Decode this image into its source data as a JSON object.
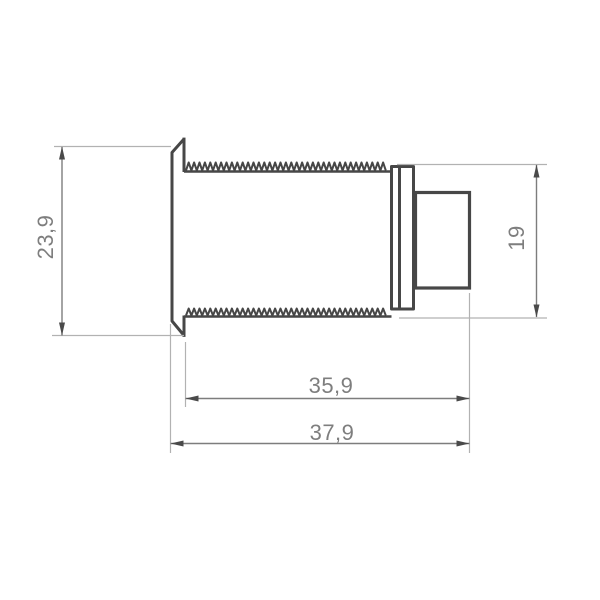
{
  "drawing": {
    "kind": "technical-dimension-drawing",
    "view": "side-profile",
    "decimal_separator": ",",
    "dimensions": [
      {
        "id": "flange-height",
        "label": "23,9",
        "value": 23.9,
        "orientation": "vertical",
        "side": "left"
      },
      {
        "id": "body-height",
        "label": "19",
        "value": 19,
        "orientation": "vertical",
        "side": "right"
      },
      {
        "id": "thread-length",
        "label": "35,9",
        "value": 35.9,
        "orientation": "horizontal",
        "side": "bottom"
      },
      {
        "id": "overall-length",
        "label": "37,9",
        "value": 37.9,
        "orientation": "horizontal",
        "side": "bottom"
      }
    ],
    "colors": {
      "outline": "#474747",
      "dimension_line": "#7d7d7d",
      "extension_line": "#b2b2b2",
      "text": "#7e7e7e",
      "background": "#ffffff"
    }
  }
}
